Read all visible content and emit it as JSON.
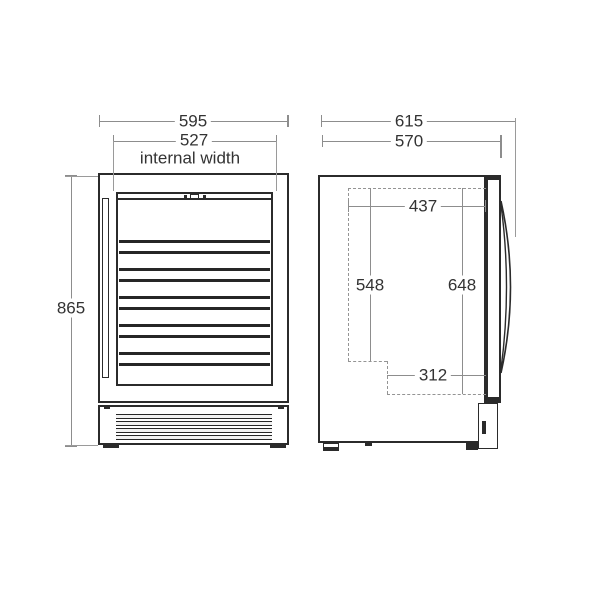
{
  "front_view": {
    "width_mm": "595",
    "internal_width_mm": "527",
    "internal_width_label": "internal width",
    "height_mm": "865"
  },
  "side_view": {
    "depth_overall_mm": "615",
    "depth_body_mm": "570",
    "internal_depth_mm": "437",
    "internal_height_front_mm": "548",
    "internal_height_rear_mm": "648",
    "internal_depth_lower_mm": "312"
  },
  "colors": {
    "outline": "#2b2b2b",
    "dimension_line": "#8d8d8d",
    "dashed_line": "#949494",
    "text": "#333333",
    "background": "#ffffff"
  }
}
